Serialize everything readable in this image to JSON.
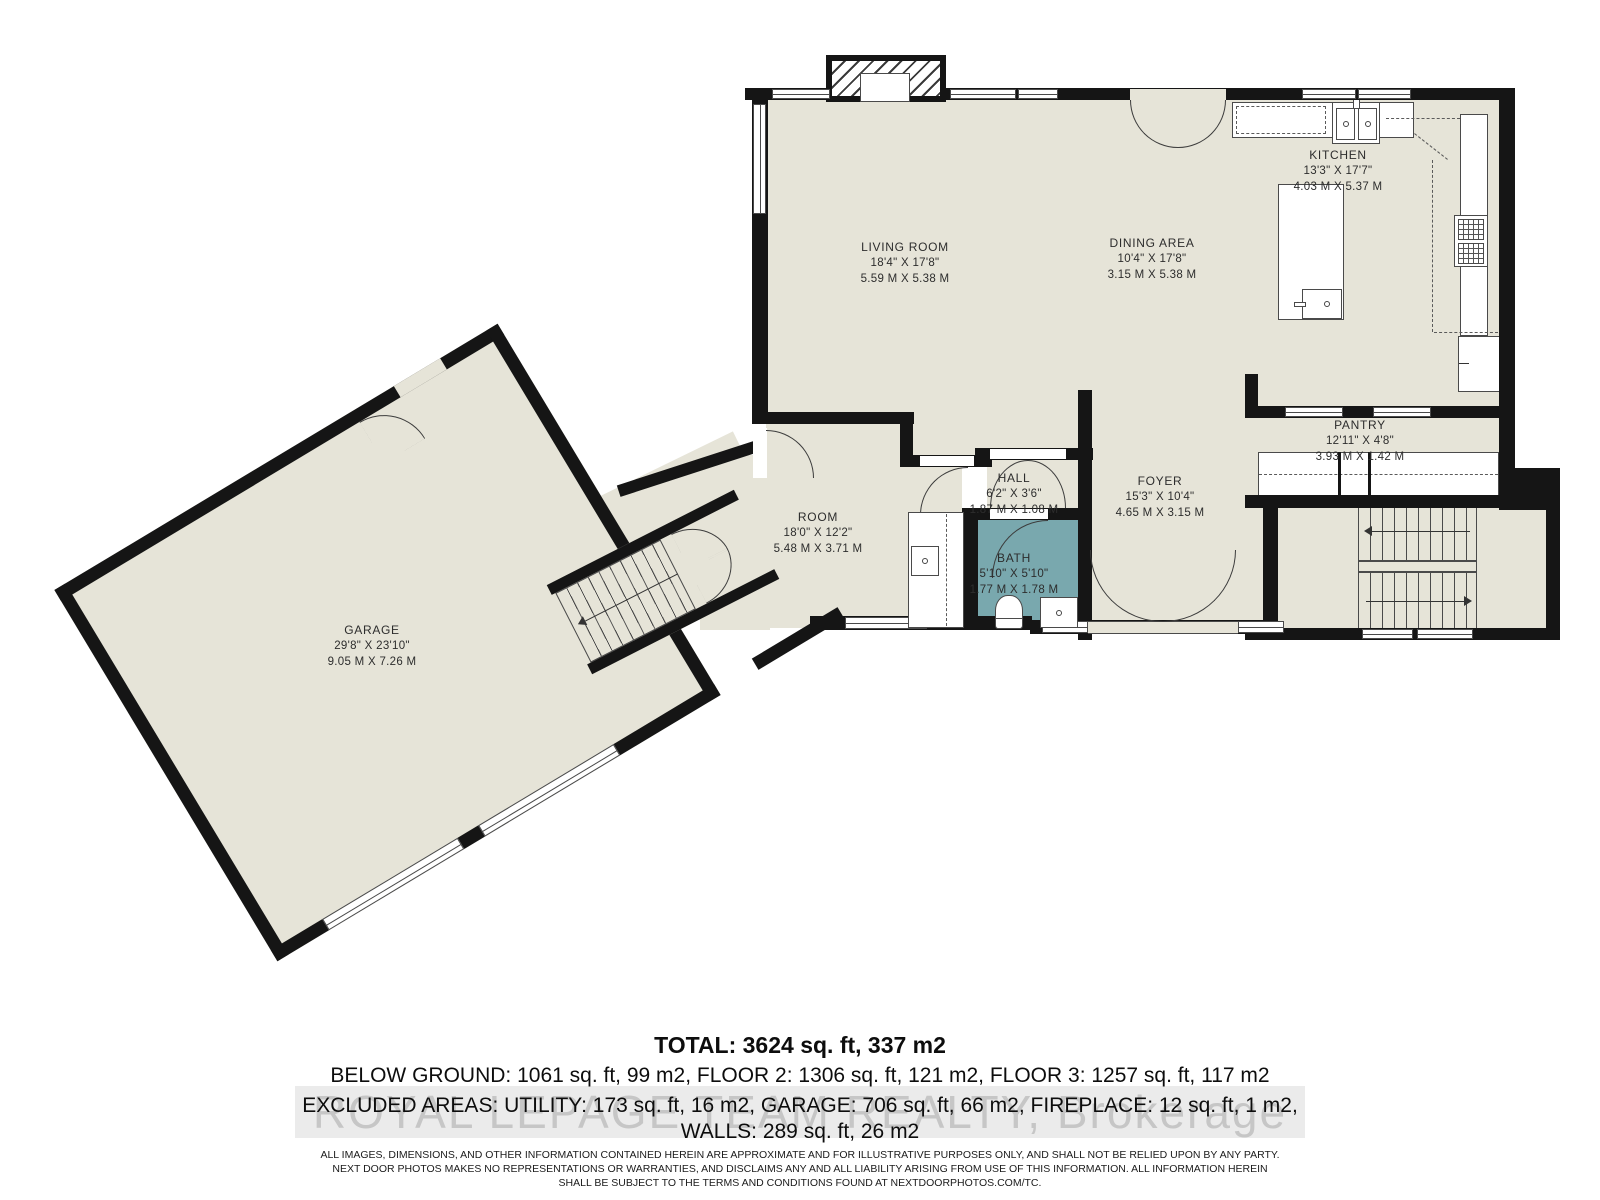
{
  "colors": {
    "floor": "#e6e4d8",
    "wall": "#151515",
    "bath": "#79a8ae",
    "watermark": "#c6c6c6"
  },
  "rooms": {
    "living": {
      "name": "LIVING ROOM",
      "imperial": "18'4\" X 17'8\"",
      "metric": "5.59 M X 5.38 M"
    },
    "dining": {
      "name": "DINING AREA",
      "imperial": "10'4\" X 17'8\"",
      "metric": "3.15 M X 5.38 M"
    },
    "kitchen": {
      "name": "KITCHEN",
      "imperial": "13'3\" X 17'7\"",
      "metric": "4.03 M X 5.37 M"
    },
    "pantry": {
      "name": "PANTRY",
      "imperial": "12'11\" X 4'8\"",
      "metric": "3.93 M X 1.42 M"
    },
    "foyer": {
      "name": "FOYER",
      "imperial": "15'3\" X 10'4\"",
      "metric": "4.65 M X 3.15 M"
    },
    "hall": {
      "name": "HALL",
      "imperial": "6'2\" X 3'6\"",
      "metric": "1.87 M X 1.08 M"
    },
    "bath": {
      "name": "BATH",
      "imperial": "5'10\" X 5'10\"",
      "metric": "1.77 M X 1.78 M"
    },
    "room": {
      "name": "ROOM",
      "imperial": "18'0\" X 12'2\"",
      "metric": "5.48 M X 3.71 M"
    },
    "garage": {
      "name": "GARAGE",
      "imperial": "29'8\" X 23'10\"",
      "metric": "9.05 M X 7.26 M"
    }
  },
  "summary": {
    "total": "TOTAL: 3624 sq. ft, 337 m2",
    "line2": "BELOW GROUND: 1061 sq. ft, 99 m2, FLOOR 2: 1306 sq. ft, 121 m2, FLOOR 3: 1257 sq. ft, 117 m2",
    "line3": "EXCLUDED AREAS: UTILITY: 173 sq. ft, 16 m2, GARAGE: 706 sq. ft, 66 m2, FIREPLACE: 12 sq. ft, 1 m2,",
    "line4": "WALLS: 289 sq. ft, 26 m2"
  },
  "watermark": "ROYAL LEPAGE TEAM REALTY, Brokerage",
  "disclaimer": {
    "line1": "ALL IMAGES, DIMENSIONS, AND OTHER INFORMATION CONTAINED HEREIN ARE APPROXIMATE AND FOR ILLUSTRATIVE PURPOSES ONLY, AND SHALL NOT BE RELIED UPON BY ANY PARTY.",
    "line2": "NEXT DOOR PHOTOS MAKES NO REPRESENTATIONS OR WARRANTIES, AND DISCLAIMS ANY AND ALL LIABILITY ARISING FROM USE OF THIS INFORMATION. ALL INFORMATION HEREIN",
    "line3": "SHALL BE SUBJECT TO THE TERMS AND CONDITIONS FOUND AT NEXTDOORPHOTOS.COM/TC."
  }
}
